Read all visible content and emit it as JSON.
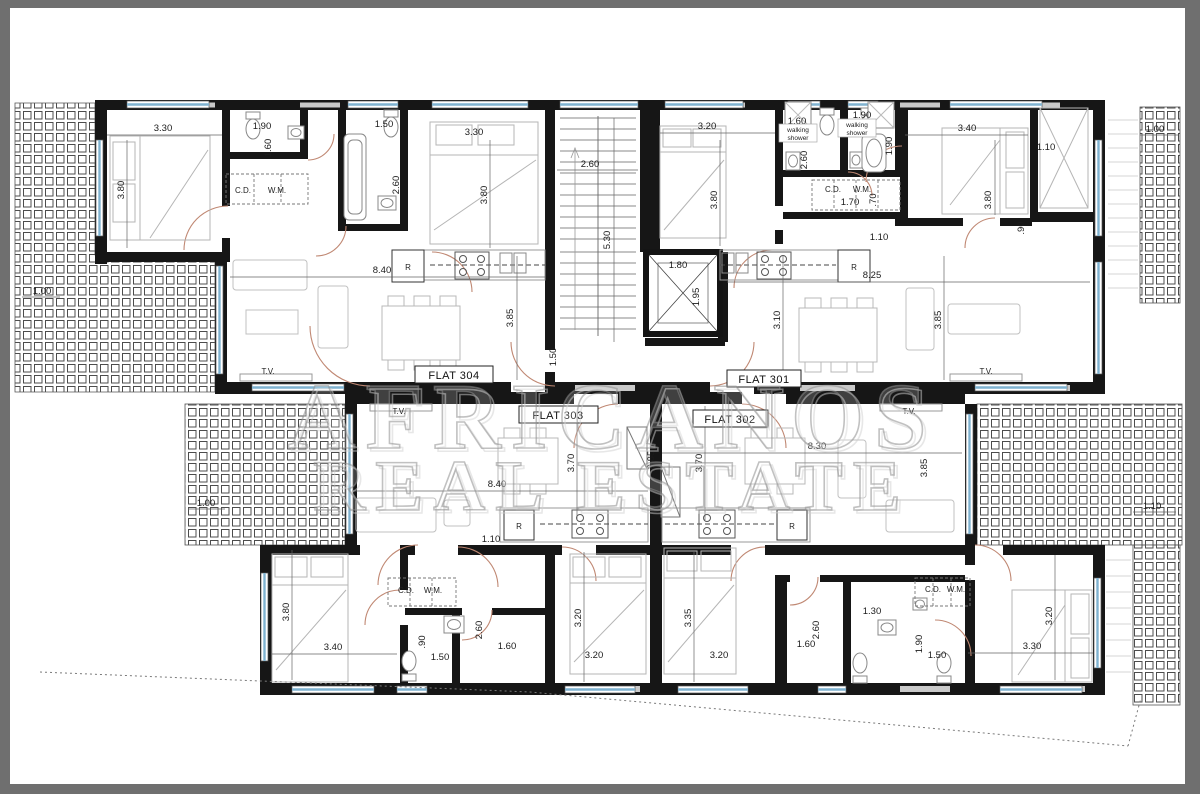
{
  "frame": {
    "border_color": "#6f6f6f",
    "canvas_color": "#ffffff"
  },
  "watermark": {
    "line1": "AFRICANOS",
    "line2": "REAL ESTATE"
  },
  "flats": {
    "f304": "FLAT 304",
    "f301": "FLAT 301",
    "f303": "FLAT 303",
    "f302": "FLAT 302"
  },
  "labels": {
    "tv": "T.V.",
    "cd": "C.D.",
    "wm": "W.M.",
    "fridge": "R",
    "walking": "walking",
    "shower": "shower"
  },
  "dims": {
    "v070": ".70",
    "v090": ".90",
    "v100": "1.00",
    "v110": "1.10",
    "v130": "1.30",
    "v150": "1.50",
    "v160": "1.60",
    "v170": "1.70",
    "v180": "1.80",
    "v190": "1.90",
    "v195": "1.95",
    "v260": "2.60",
    "v310": "3.10",
    "v320": "3.20",
    "v330": "3.30",
    "v335": "3.35",
    "v340": "3.40",
    "v370": "3.70",
    "v380": "3.80",
    "v385": "3.85",
    "v530": "5.30",
    "v825": "8.25",
    "v830": "8.30",
    "v840": "8.40"
  }
}
